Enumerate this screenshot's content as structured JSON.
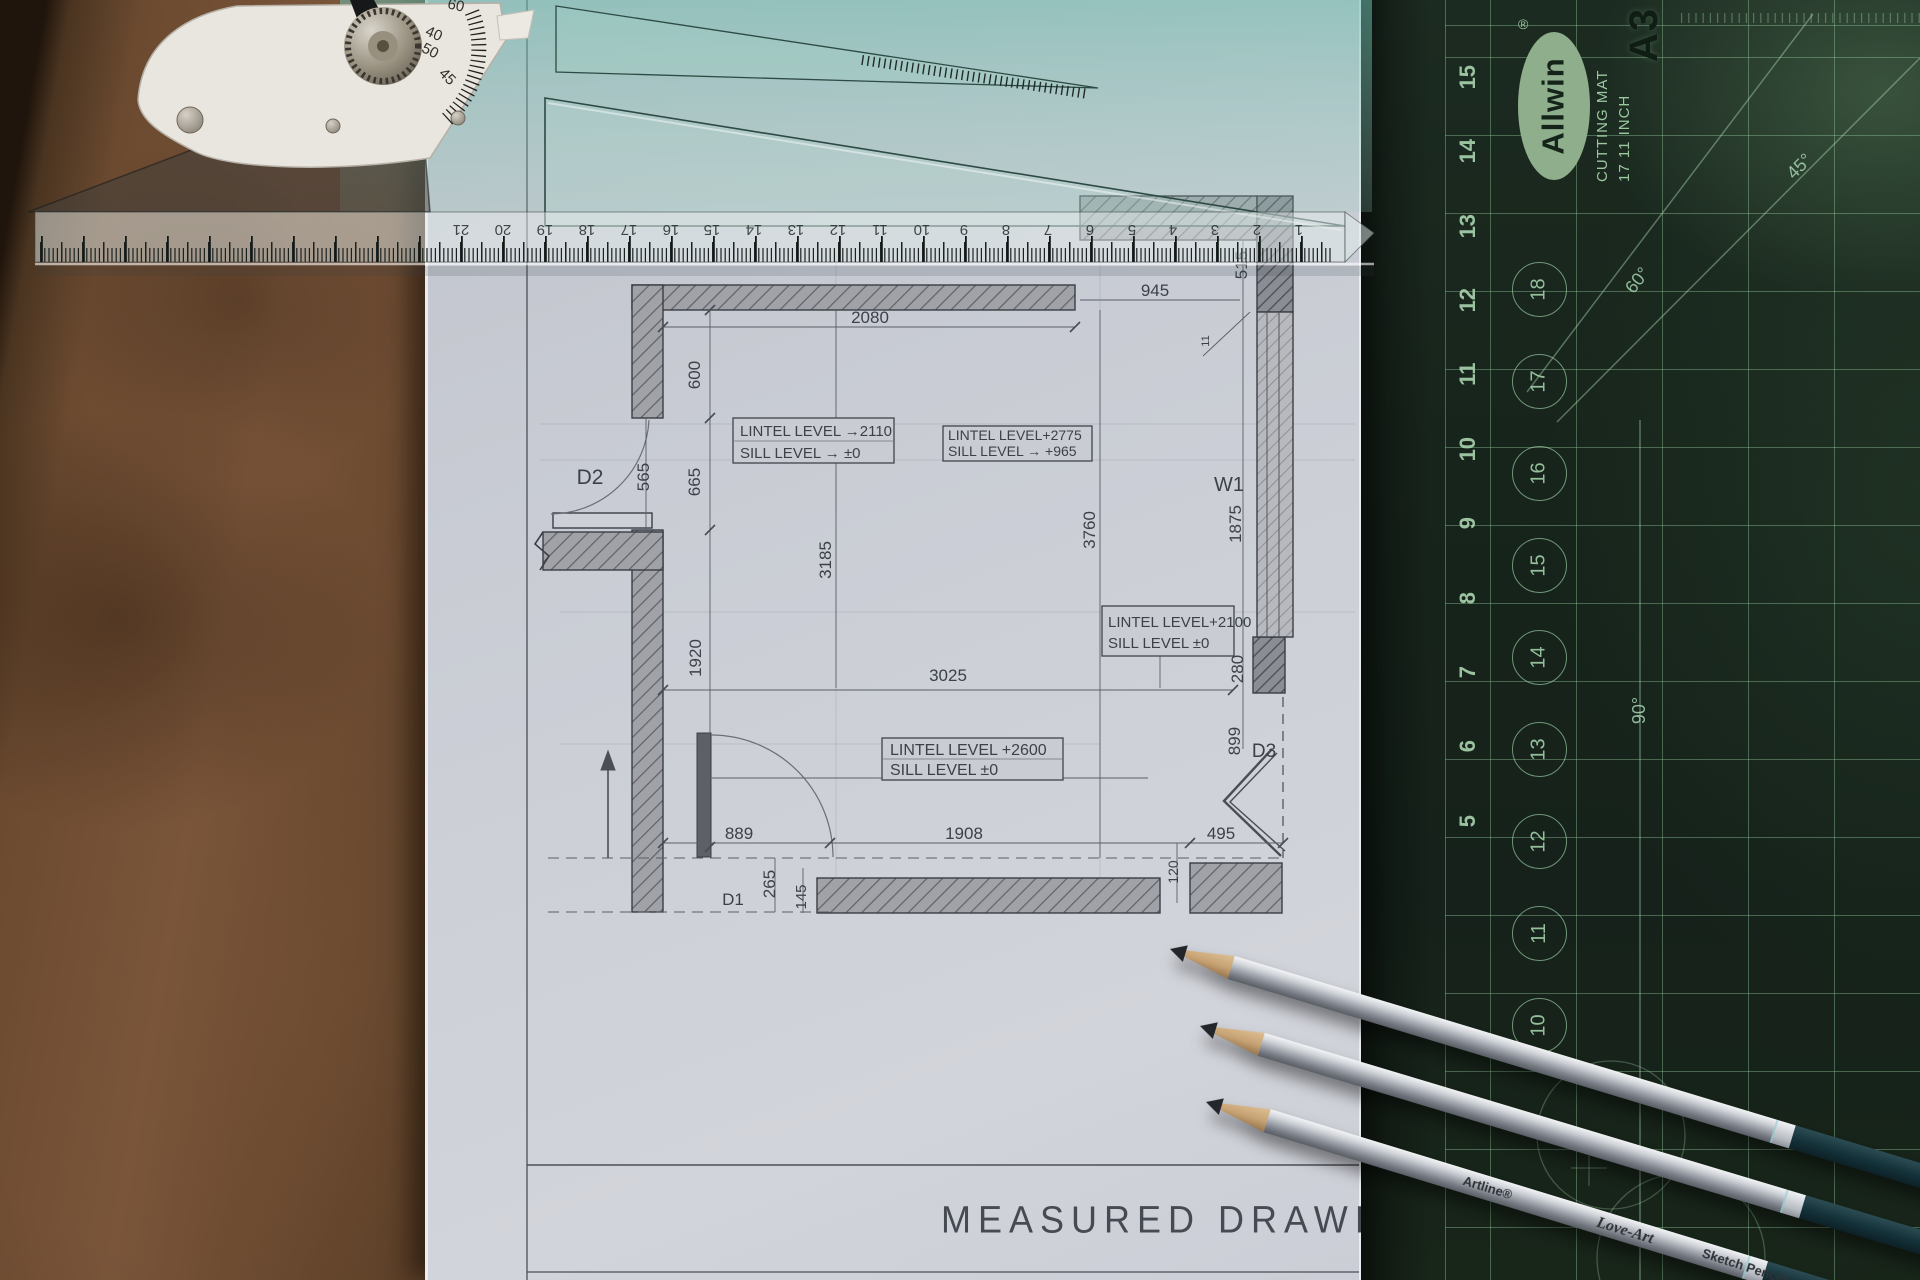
{
  "colors": {
    "mat_green": "#17241b",
    "mat_line": "#96cda0",
    "paper": "#cdd0d7",
    "board_brown": "#6f4d33",
    "ruler_teal": "#8cc4b6"
  },
  "scene": {
    "title": "MEASURED DRAWING"
  },
  "plan": {
    "dims": {
      "top": "2080",
      "top_right": "945",
      "wall_gap": "515",
      "small": "11",
      "v600": "600",
      "v565": "565",
      "v665": "665",
      "v1920": "1920",
      "v3185": "3185",
      "v3760": "3760",
      "v1875": "1875",
      "h3025": "3025",
      "v280": "280",
      "v899": "899",
      "h495": "495",
      "h889": "889",
      "h1908": "1908",
      "v265": "265",
      "v145": "145",
      "v120": "120"
    },
    "openings": {
      "d1": "D1",
      "d2": "D2",
      "d3": "D3",
      "w1": "W1"
    },
    "notes": {
      "n1": [
        "LINTEL LEVEL →2110",
        "SILL LEVEL  → ±0"
      ],
      "n2": [
        "LINTEL LEVEL+2775",
        "SILL LEVEL → +965"
      ],
      "n3": [
        "LINTEL LEVEL+2100",
        "SILL LEVEL ±0"
      ],
      "n4": [
        "LINTEL LEVEL +2600",
        "SILL LEVEL  ±0"
      ]
    }
  },
  "ruler": {
    "numbers": [
      "21",
      "20",
      "19",
      "18",
      "17",
      "16",
      "15",
      "14",
      "13",
      "12",
      "11",
      "10",
      "9",
      "8",
      "7",
      "6",
      "5",
      "4",
      "3",
      "2",
      "1"
    ]
  },
  "tool": {
    "labels": {
      "l60": "60",
      "l40": "40",
      "l50": "50",
      "l45": "45"
    }
  },
  "mat": {
    "brand": "Allwin",
    "registered": "®",
    "product": "CUTTING MAT",
    "size": "17  11 INCH",
    "format": "A3",
    "scale_numbers": [
      "15",
      "14",
      "13",
      "12",
      "11",
      "10",
      "9",
      "8",
      "7",
      "6",
      "5"
    ],
    "circle_numbers": [
      "18",
      "17",
      "16",
      "15",
      "14",
      "13",
      "12",
      "11",
      "10"
    ],
    "angle_45": "45°",
    "angle_60": "60°",
    "angle_90": "90°"
  },
  "pencil": {
    "brand": "Artline",
    "registered": "®",
    "series": "Love-Art",
    "suffix": "Sketch Pencils"
  }
}
